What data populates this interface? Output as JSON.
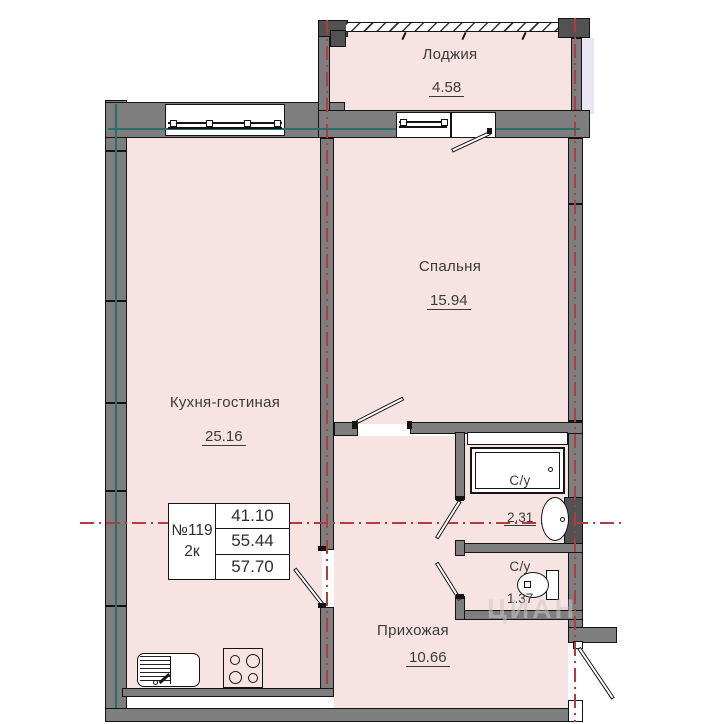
{
  "plan": {
    "title": "apartment-floor-plan",
    "rooms": [
      {
        "name": "loggia",
        "label": "Лоджия",
        "area": "4.58"
      },
      {
        "name": "bedroom",
        "label": "Спальня",
        "area": "15.94"
      },
      {
        "name": "kitchen-living",
        "label": "Кухня-гостиная",
        "area": "25.16"
      },
      {
        "name": "hallway",
        "label": "Прихожая",
        "area": "10.66"
      },
      {
        "name": "bathroom-1",
        "label": "С/у",
        "area": "2.31"
      },
      {
        "name": "bathroom-2",
        "label": "С/у",
        "area": "1.37"
      }
    ],
    "info_table": {
      "unit_number": "№119",
      "unit_type": "2к",
      "value_1": "41.10",
      "value_2": "55.44",
      "value_total": "57.70"
    },
    "watermark": "ЦИАН",
    "colors": {
      "room_fill": "#f8e3e3",
      "wall": "#7e7e7e",
      "axis_red": "#b23b3b",
      "axis_teal": "#2e6e6a",
      "total_area_red": "#c94949",
      "outside_strip": "#e9e5f1"
    }
  }
}
